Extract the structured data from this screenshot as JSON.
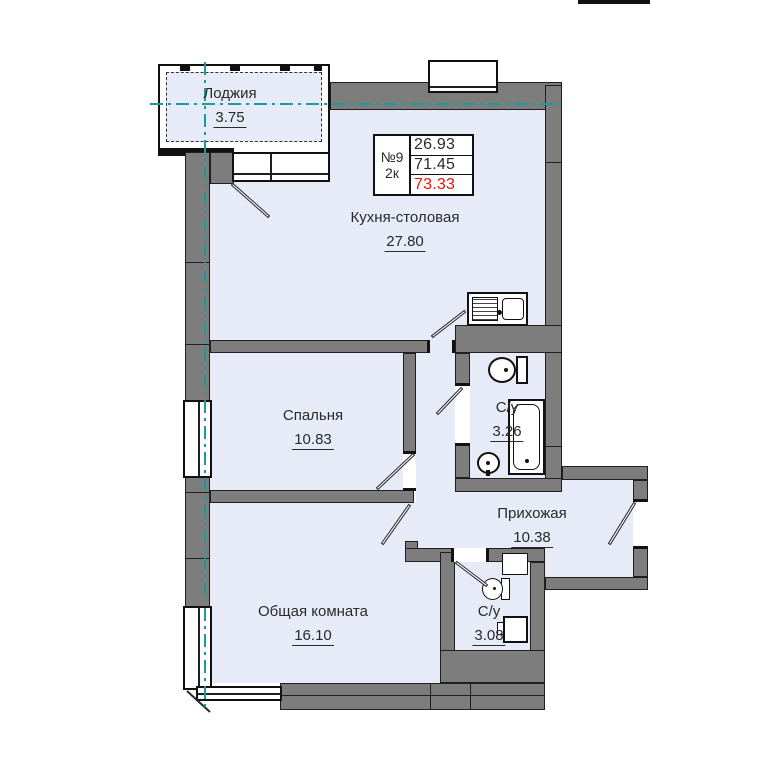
{
  "plan": {
    "unit_card": {
      "number": "№9",
      "type": "2к",
      "areas": [
        "26.93",
        "71.45",
        "73.33"
      ],
      "highlight_color": "#f2100d"
    },
    "rooms": [
      {
        "name": "Лоджия",
        "area": "3.75"
      },
      {
        "name": "Кухня-столовая",
        "area": "27.80"
      },
      {
        "name": "Спальня",
        "area": "10.83"
      },
      {
        "name": "С/у",
        "area": "3.26"
      },
      {
        "name": "Прихожая",
        "area": "10.38"
      },
      {
        "name": "Общая комната",
        "area": "16.10"
      },
      {
        "name": "С/у",
        "area": "3.08"
      }
    ],
    "icons": [
      {
        "name": "kitchen-sink-icon"
      },
      {
        "name": "toilet-icon"
      },
      {
        "name": "bathtub-icon"
      },
      {
        "name": "washbasin-icon"
      },
      {
        "name": "toilet-icon"
      },
      {
        "name": "washing-machine-icon"
      }
    ],
    "colors": {
      "room_fill": "#e7ebf8",
      "wall": "#7d7d7d",
      "centerline": "#1f9a9c",
      "area_highlight": "#f2100d"
    }
  }
}
